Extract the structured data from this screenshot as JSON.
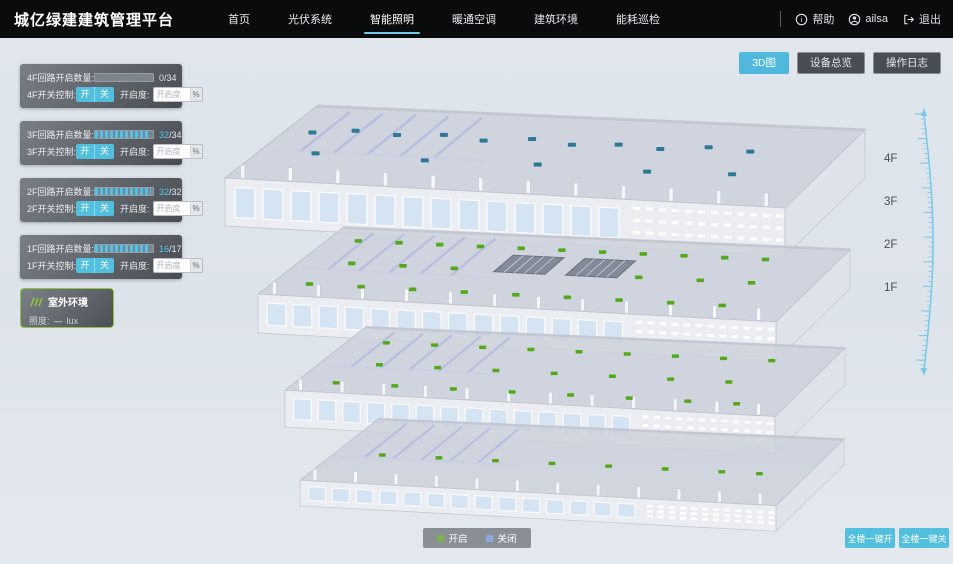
{
  "header": {
    "title": "城亿绿建建筑管理平台",
    "nav": [
      {
        "label": "首页",
        "active": false
      },
      {
        "label": "光伏系统",
        "active": false
      },
      {
        "label": "智能照明",
        "active": true
      },
      {
        "label": "暖通空调",
        "active": false
      },
      {
        "label": "建筑环境",
        "active": false
      },
      {
        "label": "能耗巡检",
        "active": false
      }
    ],
    "help_label": "帮助",
    "username": "ailsa",
    "logout_label": "退出"
  },
  "view_buttons": [
    {
      "label": "3D图",
      "active": true
    },
    {
      "label": "设备总览",
      "active": false
    },
    {
      "label": "操作日志",
      "active": false
    }
  ],
  "floor_panels": [
    {
      "floor": "4F",
      "circuit_label": "4F回路开启数量:",
      "count": "0",
      "total": "/34",
      "percent": 0,
      "count_color": "#dbdfe4",
      "switch_label": "4F开关控制:",
      "on_label": "开",
      "off_label": "关",
      "openness_label": "开启度:",
      "openness_placeholder": "开启度",
      "unit": "%"
    },
    {
      "floor": "3F",
      "circuit_label": "3F回路开启数量:",
      "count": "32",
      "total": "/34",
      "percent": 94,
      "count_color": "#53c6ec",
      "switch_label": "3F开关控制:",
      "on_label": "开",
      "off_label": "关",
      "openness_label": "开启度:",
      "openness_placeholder": "开启度",
      "unit": "%"
    },
    {
      "floor": "2F",
      "circuit_label": "2F回路开启数量:",
      "count": "32",
      "total": "/32",
      "percent": 97,
      "count_color": "#53c6ec",
      "switch_label": "2F开关控制:",
      "on_label": "开",
      "off_label": "关",
      "openness_label": "开启度:",
      "openness_placeholder": "开启度",
      "unit": "%"
    },
    {
      "floor": "1F",
      "circuit_label": "1F回路开启数量:",
      "count": "16",
      "total": "/17",
      "percent": 94,
      "count_color": "#53c6ec",
      "switch_label": "1F开关控制:",
      "on_label": "开",
      "off_label": "关",
      "openness_label": "开启度:",
      "openness_placeholder": "开启度",
      "unit": "%"
    }
  ],
  "outdoor_panel": {
    "title": "室外环境",
    "illuminance_label": "照度:",
    "value": "—",
    "unit": "lux"
  },
  "legend": {
    "on_label": "开启",
    "on_color": "#7cb050",
    "off_label": "关闭",
    "off_color": "#8fa8dc"
  },
  "bulk_buttons": [
    {
      "label": "全楼一键开"
    },
    {
      "label": "全楼一键关"
    }
  ],
  "floor_markers": [
    "4F",
    "3F",
    "2F",
    "1F"
  ],
  "colors": {
    "accent": "#53bfdf",
    "nav_active_underline": "#6ecbe8",
    "light_on": "#54a81c",
    "light_off": "#2e7795",
    "ruler": "#79c8e6"
  },
  "building": {
    "floors": [
      {
        "id": "4F",
        "tx": 225,
        "ty": 100,
        "s": 1.0,
        "face_h": 48,
        "win_h": 30,
        "light_color": "#2e7795",
        "atrium": false,
        "lights": [
          [
            0.05,
            0.35
          ],
          [
            0.12,
            0.3
          ],
          [
            0.2,
            0.33
          ],
          [
            0.28,
            0.3
          ],
          [
            0.36,
            0.35
          ],
          [
            0.44,
            0.3
          ],
          [
            0.52,
            0.35
          ],
          [
            0.6,
            0.32
          ],
          [
            0.68,
            0.35
          ],
          [
            0.76,
            0.3
          ],
          [
            0.84,
            0.33
          ],
          [
            0.1,
            0.62
          ],
          [
            0.3,
            0.64
          ],
          [
            0.5,
            0.62
          ],
          [
            0.7,
            0.64
          ],
          [
            0.85,
            0.62
          ]
        ]
      },
      {
        "id": "3F",
        "tx": 258,
        "ty": 222,
        "s": 0.925,
        "face_h": 42,
        "win_h": 24,
        "light_color": "#54a81c",
        "atrium": true,
        "lights": [
          [
            0.06,
            0.18
          ],
          [
            0.14,
            0.18
          ],
          [
            0.22,
            0.18
          ],
          [
            0.3,
            0.18
          ],
          [
            0.38,
            0.18
          ],
          [
            0.46,
            0.18
          ],
          [
            0.54,
            0.18
          ],
          [
            0.62,
            0.18
          ],
          [
            0.7,
            0.18
          ],
          [
            0.78,
            0.18
          ],
          [
            0.86,
            0.18
          ],
          [
            0.1,
            0.5
          ],
          [
            0.2,
            0.5
          ],
          [
            0.3,
            0.5
          ],
          [
            0.66,
            0.5
          ],
          [
            0.78,
            0.5
          ],
          [
            0.88,
            0.5
          ],
          [
            0.07,
            0.82
          ],
          [
            0.17,
            0.82
          ],
          [
            0.27,
            0.82
          ],
          [
            0.37,
            0.82
          ],
          [
            0.47,
            0.82
          ],
          [
            0.57,
            0.82
          ],
          [
            0.67,
            0.82
          ],
          [
            0.77,
            0.82
          ],
          [
            0.87,
            0.82
          ]
        ]
      },
      {
        "id": "2F",
        "tx": 285,
        "ty": 322,
        "s": 0.875,
        "face_h": 42,
        "win_h": 24,
        "light_color": "#54a81c",
        "atrium": false,
        "lights": [
          [
            0.08,
            0.22
          ],
          [
            0.18,
            0.22
          ],
          [
            0.28,
            0.22
          ],
          [
            0.38,
            0.22
          ],
          [
            0.48,
            0.22
          ],
          [
            0.58,
            0.22
          ],
          [
            0.68,
            0.22
          ],
          [
            0.78,
            0.22
          ],
          [
            0.88,
            0.22
          ],
          [
            0.12,
            0.55
          ],
          [
            0.24,
            0.55
          ],
          [
            0.36,
            0.55
          ],
          [
            0.48,
            0.55
          ],
          [
            0.6,
            0.55
          ],
          [
            0.72,
            0.55
          ],
          [
            0.84,
            0.55
          ],
          [
            0.08,
            0.85
          ],
          [
            0.2,
            0.85
          ],
          [
            0.32,
            0.85
          ],
          [
            0.44,
            0.85
          ],
          [
            0.56,
            0.85
          ],
          [
            0.68,
            0.85
          ],
          [
            0.8,
            0.85
          ],
          [
            0.9,
            0.85
          ]
        ]
      },
      {
        "id": "1F",
        "tx": 300,
        "ty": 414,
        "s": 0.85,
        "face_h": 30,
        "win_h": 16,
        "light_color": "#54a81c",
        "atrium": false,
        "lights": [
          [
            0.1,
            0.55
          ],
          [
            0.22,
            0.55
          ],
          [
            0.34,
            0.55
          ],
          [
            0.46,
            0.55
          ],
          [
            0.58,
            0.55
          ],
          [
            0.7,
            0.55
          ],
          [
            0.82,
            0.55
          ],
          [
            0.9,
            0.55
          ]
        ]
      }
    ]
  }
}
